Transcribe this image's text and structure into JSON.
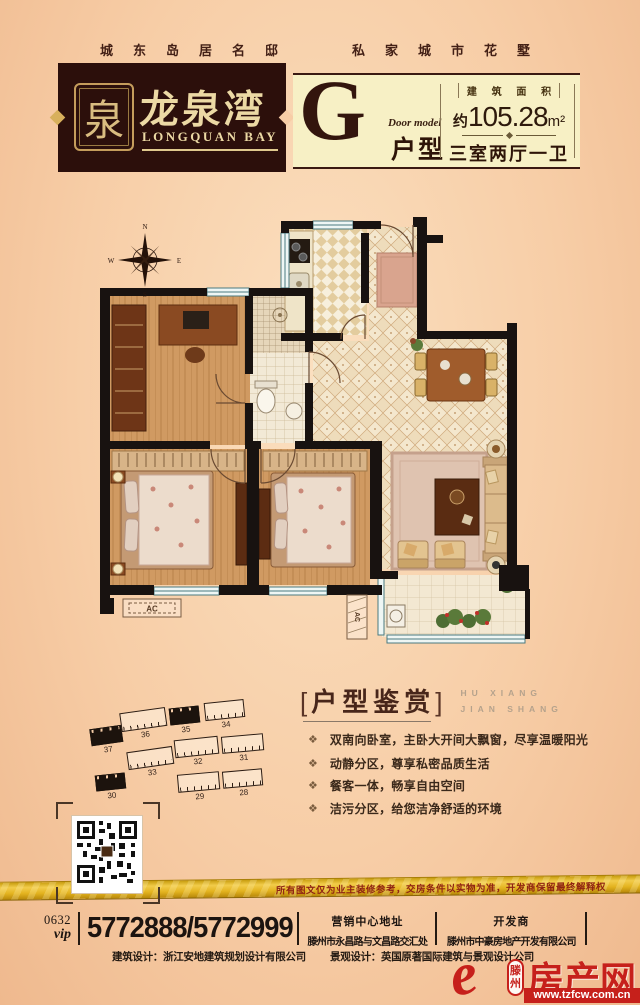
{
  "header": {
    "slogan_left": "城东岛居名邸",
    "slogan_right": "私家城市花墅"
  },
  "logo": {
    "seal_char": "泉",
    "name_cn": "龙泉湾",
    "name_en": "LONGQUAN BAY"
  },
  "unit": {
    "letter": "G",
    "door_model": "Door model",
    "type_cn": "户型",
    "area_label": "建 筑 面 积",
    "area_prefix": "约",
    "area_number": "105.28",
    "area_unit": "m²",
    "rooms": "三室两厅一卫"
  },
  "floorplan": {
    "compass": {
      "n": "N",
      "e": "E",
      "s": "S",
      "w": "W"
    },
    "ac1": "AC",
    "ac2": "AC"
  },
  "icons": {
    "bullet": "❖"
  },
  "appreciation": {
    "bracket_open": "[",
    "title": "户型鉴赏",
    "bracket_close": "]",
    "subtitle1": "HU XIANG",
    "subtitle2": "JIAN SHANG",
    "bullets": [
      "双南向卧室，主卧大开间大飘窗，尽享温暖阳光",
      "动静分区，尊享私密品质生活",
      "餐客一体，畅享自由空间",
      "洁污分区，给您洁净舒适的环境"
    ]
  },
  "siteplan": {
    "buildings": [
      {
        "no": "37",
        "filled": true,
        "x": 6,
        "y": 29,
        "w": 32,
        "h": 15,
        "r": -8
      },
      {
        "no": "36",
        "filled": false,
        "x": 36,
        "y": 12,
        "w": 46,
        "h": 17,
        "r": -8
      },
      {
        "no": "35",
        "filled": true,
        "x": 85,
        "y": 9,
        "w": 30,
        "h": 15,
        "r": -6
      },
      {
        "no": "34",
        "filled": false,
        "x": 120,
        "y": 3,
        "w": 40,
        "h": 16,
        "r": -6
      },
      {
        "no": "33",
        "filled": false,
        "x": 43,
        "y": 51,
        "w": 46,
        "h": 16,
        "r": -8
      },
      {
        "no": "32",
        "filled": false,
        "x": 90,
        "y": 40,
        "w": 44,
        "h": 16,
        "r": -6
      },
      {
        "no": "31",
        "filled": false,
        "x": 137,
        "y": 37,
        "w": 42,
        "h": 15,
        "r": -5
      },
      {
        "no": "30",
        "filled": true,
        "x": 11,
        "y": 76,
        "w": 30,
        "h": 14,
        "r": -6
      },
      {
        "no": "29",
        "filled": false,
        "x": 93,
        "y": 75,
        "w": 42,
        "h": 16,
        "r": -5
      },
      {
        "no": "28",
        "filled": false,
        "x": 138,
        "y": 72,
        "w": 40,
        "h": 15,
        "r": -5
      }
    ]
  },
  "disclaimer": "所有图文仅为业主装修参考，交房条件以实物为准，开发商保留最终解释权",
  "contact": {
    "area_code": "0632",
    "vip": "vip",
    "phones": "5772888/5772999"
  },
  "footer": {
    "marketing_title": "营销中心地址",
    "marketing_address": "滕州市永昌路与文昌路交汇处",
    "developer_title": "开发商",
    "developer_name": "滕州市中豪房地产开发有限公司",
    "architecture": "建筑设计：浙江安地建筑规划设计有限公司",
    "landscape": "景观设计：英国原著国际建筑与景观设计公司"
  },
  "brand": {
    "glyph": "e",
    "city_top": "滕",
    "city_bottom": "州",
    "name": "房产网",
    "url": "www.tzfcw.com.cn"
  }
}
